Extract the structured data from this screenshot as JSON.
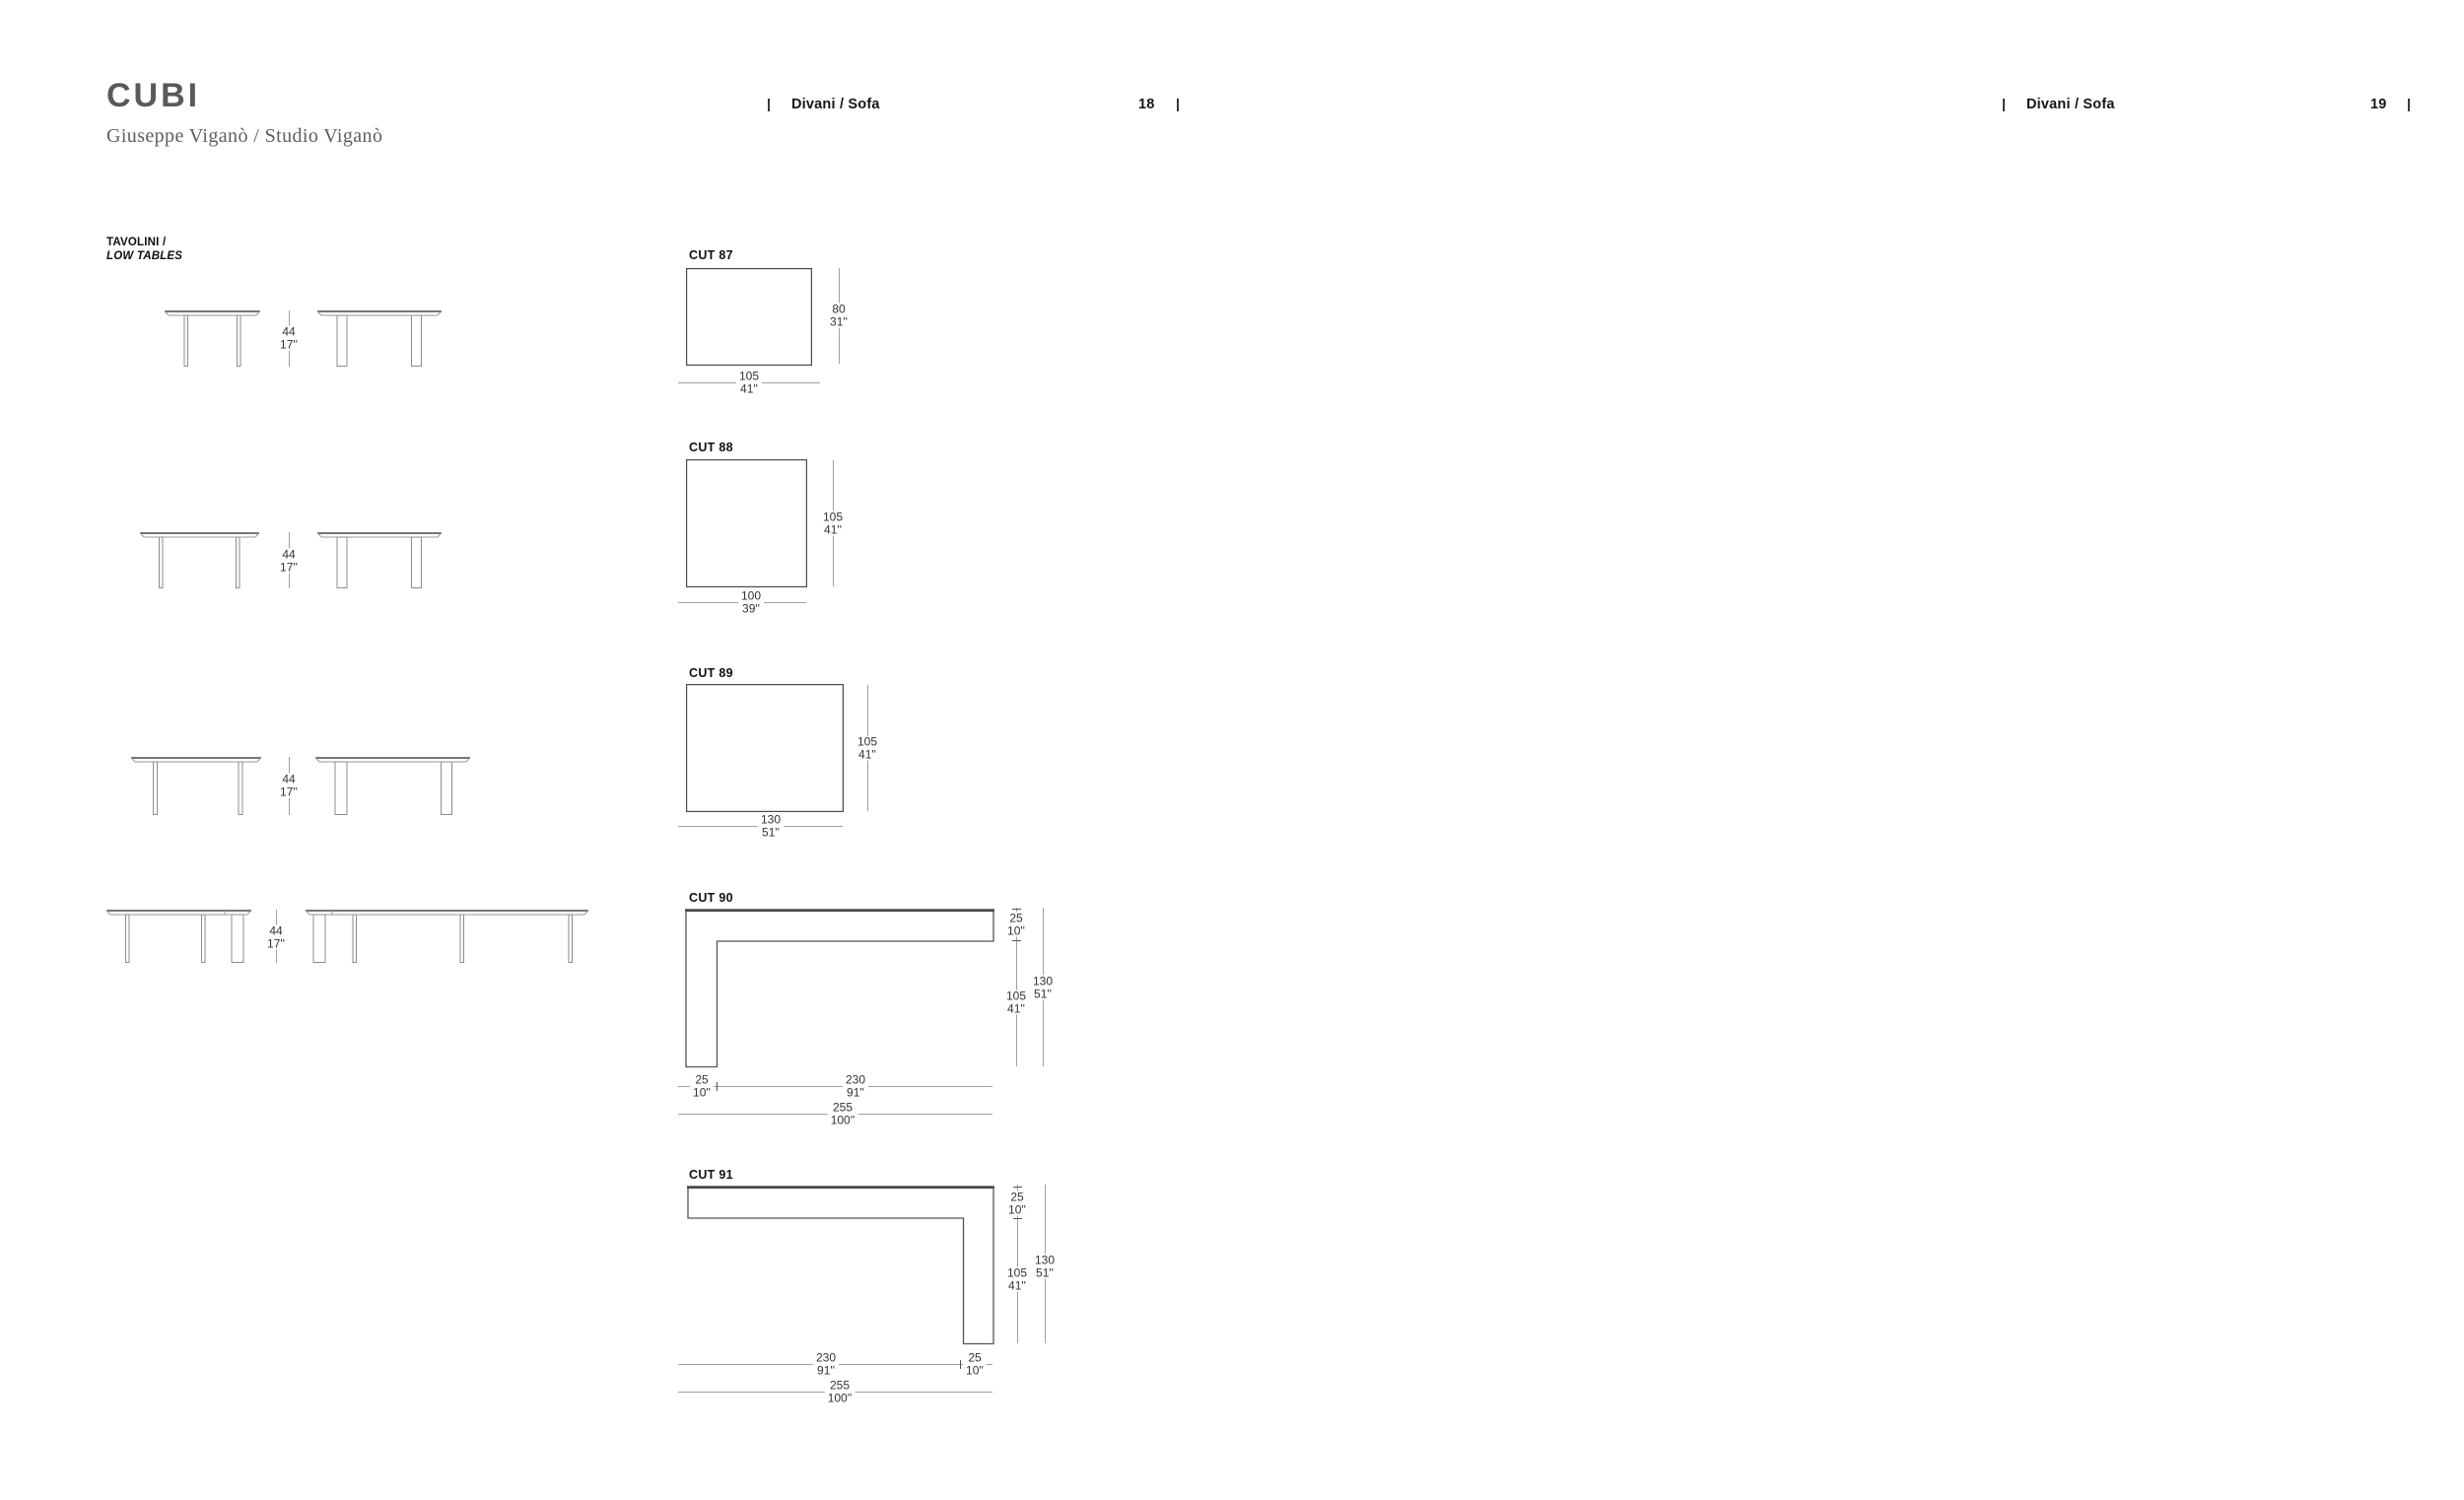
{
  "page": {
    "title": "CUBI",
    "designer": "Giuseppe Viganò / Studio Viganò",
    "running_headers": [
      {
        "section": "Divani / Sofa",
        "page_number": "18"
      },
      {
        "section": "Divani / Sofa",
        "page_number": "19"
      }
    ]
  },
  "low_tables": {
    "label_line1": "TAVOLINI /",
    "label_line2": "LOW TABLES",
    "rows": [
      {
        "height": {
          "cm": "44",
          "in": "17''"
        }
      },
      {
        "height": {
          "cm": "44",
          "in": "17''"
        }
      },
      {
        "height": {
          "cm": "44",
          "in": "17''"
        }
      },
      {
        "height": {
          "cm": "44",
          "in": "17''"
        }
      }
    ]
  },
  "cuts": [
    {
      "name": "CUT 87",
      "width": {
        "cm": "105",
        "in": "41''"
      },
      "depth": {
        "cm": "80",
        "in": "31''"
      }
    },
    {
      "name": "CUT 88",
      "width": {
        "cm": "100",
        "in": "39''"
      },
      "depth": {
        "cm": "105",
        "in": "41''"
      }
    },
    {
      "name": "CUT 89",
      "width": {
        "cm": "130",
        "in": "51''"
      },
      "depth": {
        "cm": "105",
        "in": "41''"
      }
    },
    {
      "name": "CUT 90",
      "end_width": {
        "cm": "25",
        "in": "10''"
      },
      "seat_depth": {
        "cm": "105",
        "in": "41''"
      },
      "total_depth": {
        "cm": "130",
        "in": "51''"
      },
      "bottom_short": {
        "cm": "25",
        "in": "10''"
      },
      "bottom_long": {
        "cm": "230",
        "in": "91''"
      },
      "bottom_total": {
        "cm": "255",
        "in": "100''"
      }
    },
    {
      "name": "CUT 91",
      "end_width": {
        "cm": "25",
        "in": "10''"
      },
      "seat_depth": {
        "cm": "105",
        "in": "41''"
      },
      "total_depth": {
        "cm": "130",
        "in": "51''"
      },
      "bottom_short": {
        "cm": "25",
        "in": "10''"
      },
      "bottom_long": {
        "cm": "230",
        "in": "91''"
      },
      "bottom_total": {
        "cm": "255",
        "in": "100''"
      }
    }
  ],
  "colors": {
    "title_gray": "#58595d",
    "line_gray": "#a0a0a0",
    "line_dark": "#4a4a4a",
    "text_dark": "#161616"
  }
}
